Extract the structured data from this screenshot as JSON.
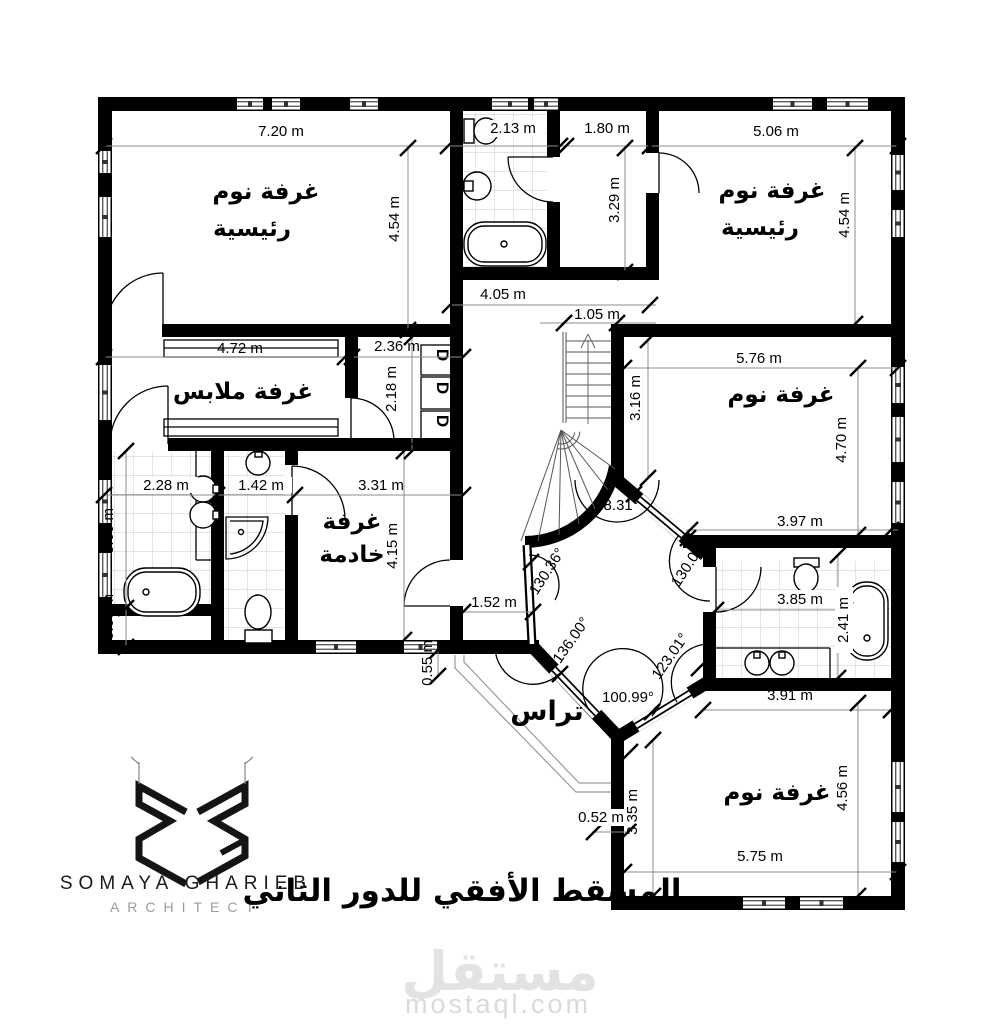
{
  "plan": {
    "rooms": {
      "master_left": {
        "line1": "غرفة نوم",
        "line2": "رئيسية"
      },
      "master_right": {
        "line1": "غرفة نوم",
        "line2": "رئيسية"
      },
      "dressing": {
        "label": "غرفة ملابس"
      },
      "maid": {
        "line1": "غرفة",
        "line2": "خادمة"
      },
      "bedroom_right": {
        "label": "غرفة نوم"
      },
      "bedroom_bottom": {
        "label": "غرفة نوم"
      },
      "terrace": {
        "label": "تراس"
      }
    },
    "closet_letter": "D",
    "dims": {
      "w720": "7.20 m",
      "w213": "2.13 m",
      "w180": "1.80 m",
      "w506": "5.06 m",
      "h454a": "4.54 m",
      "h329": "3.29 m",
      "h454b": "4.54 m",
      "w405": "4.05 m",
      "w105": "1.05 m",
      "w472": "4.72 m",
      "w236": "2.36 m",
      "h218": "2.18 m",
      "w576": "5.76 m",
      "h316": "3.16 m",
      "h470": "4.70 m",
      "w397": "3.97 m",
      "w228": "2.28 m",
      "w142": "1.42 m",
      "w331": "3.31 m",
      "h360": "3.60 m",
      "h415": "4.15 m",
      "h060": "0.60 m",
      "w152": "1.52 m",
      "h055": "0.55 m",
      "w385": "3.85 m",
      "h241": "2.41 m",
      "w391": "3.91 m",
      "h335": "3.35 m",
      "w052": "0.52 m",
      "h456": "4.56 m",
      "w575": "5.75 m"
    },
    "angles": {
      "a9831": "98.31°",
      "a13036": "130.36°",
      "a13600": "136.00°",
      "a13000": "130.00°",
      "a12301": "123.01°",
      "a10099": "100.99°"
    }
  },
  "branding": {
    "name": "SOMAYA GHARIEB",
    "role": "ARCHITECT"
  },
  "caption": "المسقط الأفقي للدور الثاني",
  "watermark": {
    "logo": "مستقل",
    "site": "mostaql.com"
  }
}
